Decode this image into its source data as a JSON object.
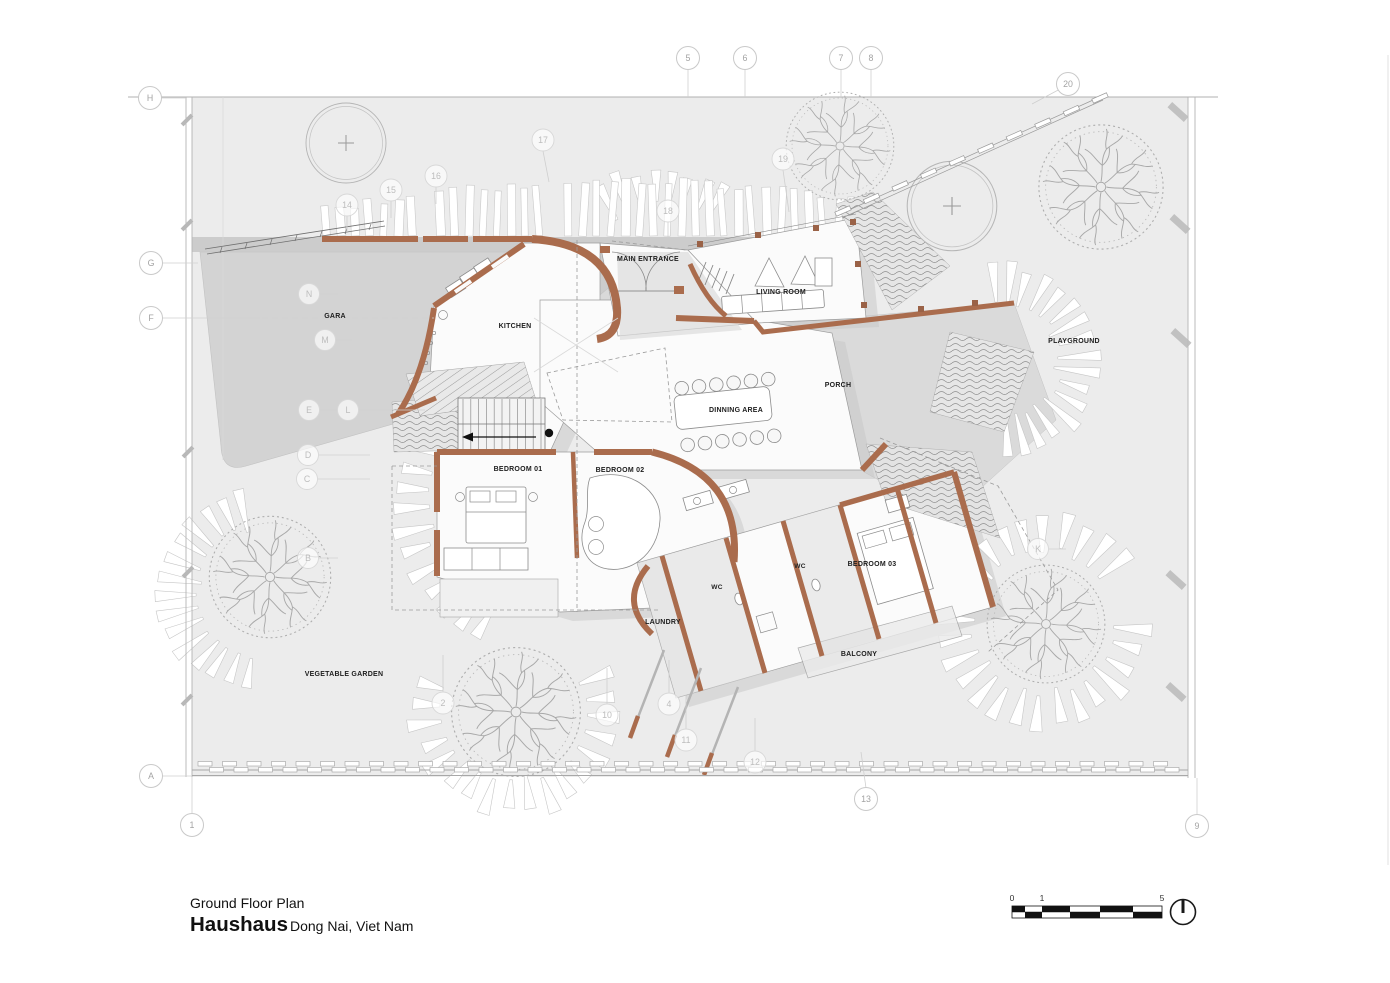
{
  "title_block": {
    "plan_name": "Ground Floor Plan",
    "project_name": "Haushaus",
    "location": "Dong Nai, Viet Nam"
  },
  "scale_bar": {
    "labels": [
      "0",
      "1",
      "5"
    ]
  },
  "rooms": [
    {
      "label": "GARA"
    },
    {
      "label": "KITCHEN"
    },
    {
      "label": "MAIN ENTRANCE"
    },
    {
      "label": "LIVING ROOM"
    },
    {
      "label": "PORCH"
    },
    {
      "label": "DINNING AREA"
    },
    {
      "label": "BEDROOM 01"
    },
    {
      "label": "BEDROOM 02"
    },
    {
      "label": "WC"
    },
    {
      "label": "WC"
    },
    {
      "label": "BEDROOM 03"
    },
    {
      "label": "LAUNDRY"
    },
    {
      "label": "BALCONY"
    },
    {
      "label": "PLAYGROUND"
    },
    {
      "label": "VEGETABLE GARDEN"
    }
  ],
  "grid_bubbles": [
    {
      "label": "H"
    },
    {
      "label": "G"
    },
    {
      "label": "F"
    },
    {
      "label": "A"
    },
    {
      "label": "1"
    },
    {
      "label": "5"
    },
    {
      "label": "6"
    },
    {
      "label": "7"
    },
    {
      "label": "8"
    },
    {
      "label": "20"
    },
    {
      "label": "9"
    },
    {
      "label": "14"
    },
    {
      "label": "15"
    },
    {
      "label": "16"
    },
    {
      "label": "17"
    },
    {
      "label": "18"
    },
    {
      "label": "19"
    },
    {
      "label": "2"
    },
    {
      "label": "10"
    },
    {
      "label": "4"
    },
    {
      "label": "11"
    },
    {
      "label": "12"
    },
    {
      "label": "13"
    },
    {
      "label": "N"
    },
    {
      "label": "M"
    },
    {
      "label": "E"
    },
    {
      "label": "L"
    },
    {
      "label": "D"
    },
    {
      "label": "C"
    },
    {
      "label": "B"
    },
    {
      "label": "K"
    }
  ],
  "colors": {
    "wall": "#AA6C4D",
    "site": "#ECECEC",
    "paving": "#D3D3D3",
    "shadow": "#C5C5C5"
  }
}
